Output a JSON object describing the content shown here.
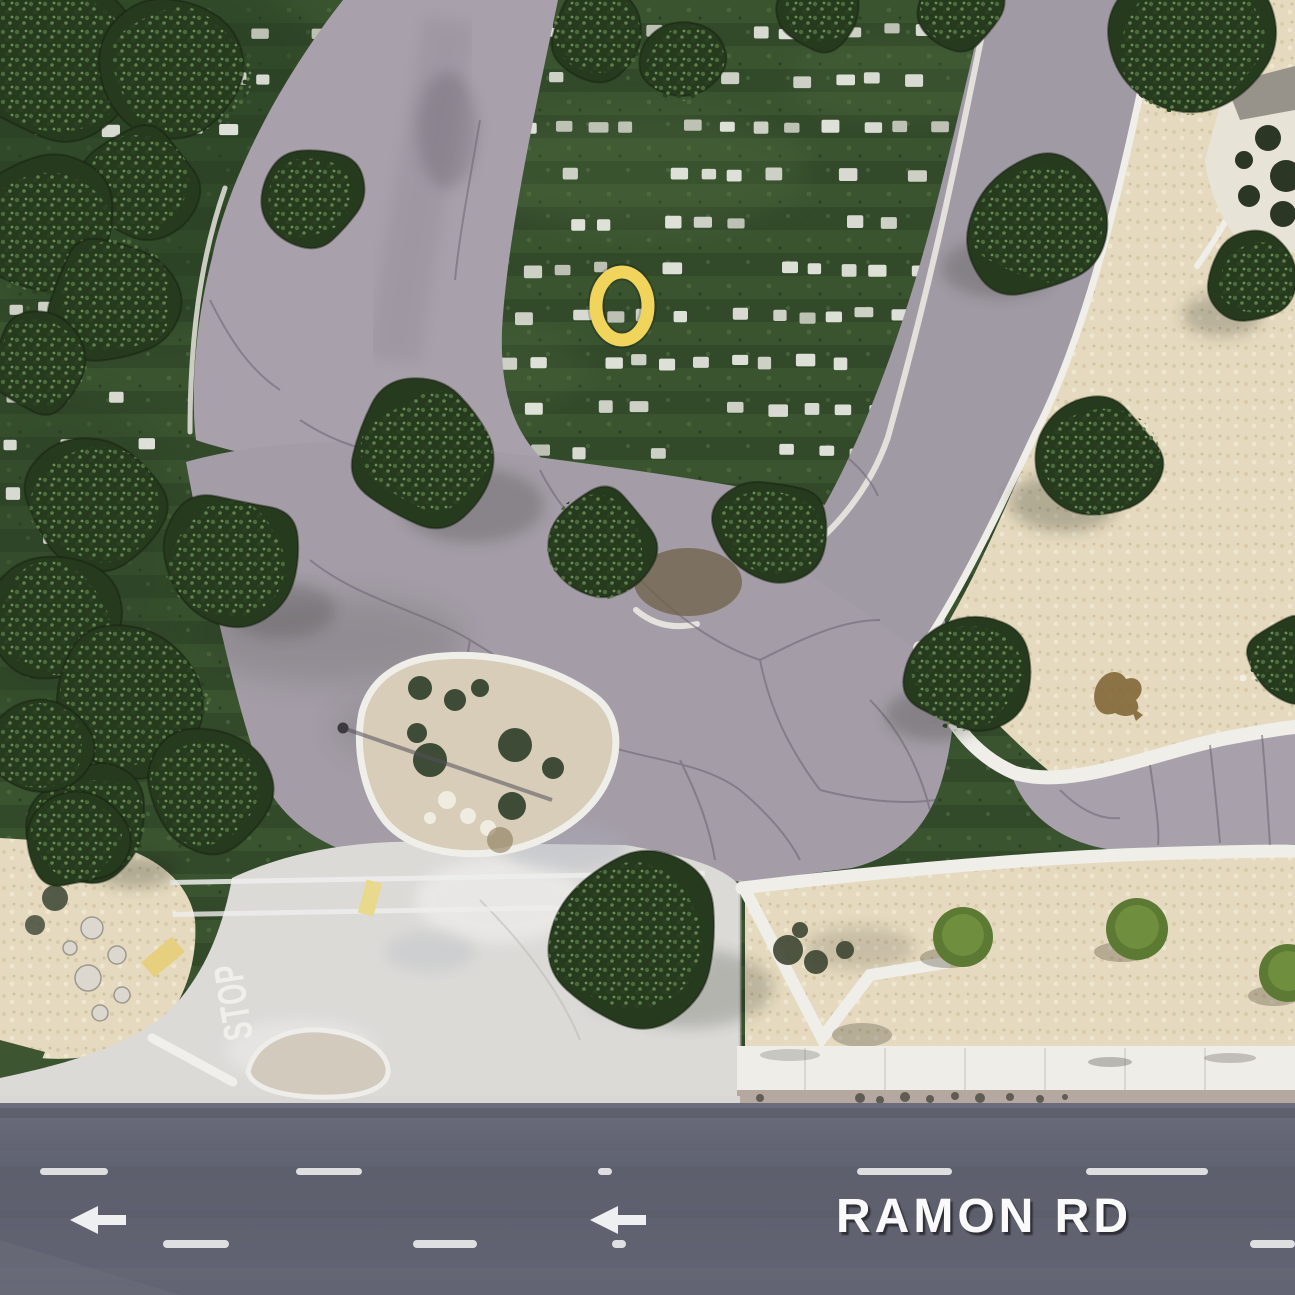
{
  "map": {
    "kind": "aerial-satellite-view",
    "location_hint": "Cemetery grounds and entrance driveway at Ramon Rd"
  },
  "road": {
    "label": "RAMON RD",
    "label_color": "#fafafa",
    "label_shadow": "#2b2b33",
    "surface_color": "#5e6070",
    "lane_arrow_direction": "left"
  },
  "entrance": {
    "stop_marking": "STOP",
    "marking_color": "#f2f1ec"
  },
  "marker": {
    "shape": "ellipse",
    "cx": 622,
    "cy": 306,
    "rx": 26,
    "ry": 34,
    "stroke_color": "#f1d45c",
    "stroke_width": 13
  },
  "palette": {
    "grass": "#3a5430",
    "grass_dark": "#32492a",
    "tree": "#263a1e",
    "pavement": "#a49da7",
    "concrete": "#dbdad7",
    "sand": "#e5dabf",
    "curb_white": "#efeee9",
    "road": "#5e6070",
    "sidewalk": "#efede8",
    "yellow_curb": "#e6cf7f"
  },
  "scene_data": {
    "headstone_rows": [
      {
        "y": 26,
        "x1": 348,
        "x2": 982,
        "seed": 11
      },
      {
        "y": 74,
        "x1": 348,
        "x2": 986,
        "seed": 23
      },
      {
        "y": 122,
        "x1": 344,
        "x2": 986,
        "seed": 37
      },
      {
        "y": 170,
        "x1": 338,
        "x2": 980,
        "seed": 41
      },
      {
        "y": 218,
        "x1": 334,
        "x2": 976,
        "seed": 53
      },
      {
        "y": 264,
        "x1": 334,
        "x2": 970,
        "seed": 67
      },
      {
        "y": 310,
        "x1": 330,
        "x2": 964,
        "seed": 71
      },
      {
        "y": 356,
        "x1": 330,
        "x2": 958,
        "seed": 83
      },
      {
        "y": 402,
        "x1": 330,
        "x2": 950,
        "seed": 97
      },
      {
        "y": 446,
        "x1": 334,
        "x2": 940,
        "seed": 101
      },
      {
        "y": 26,
        "x1": 0,
        "x2": 340,
        "seed": 7
      },
      {
        "y": 74,
        "x1": 0,
        "x2": 332,
        "seed": 13
      },
      {
        "y": 122,
        "x1": 0,
        "x2": 240,
        "seed": 17
      },
      {
        "y": 302,
        "x1": 0,
        "x2": 152,
        "seed": 19
      },
      {
        "y": 348,
        "x1": 0,
        "x2": 162,
        "seed": 29
      },
      {
        "y": 394,
        "x1": 0,
        "x2": 166,
        "seed": 31
      },
      {
        "y": 440,
        "x1": 0,
        "x2": 172,
        "seed": 43
      },
      {
        "y": 486,
        "x1": 0,
        "x2": 124,
        "seed": 47
      },
      {
        "y": 532,
        "x1": 0,
        "x2": 84,
        "seed": 59
      },
      {
        "y": 578,
        "x1": 0,
        "x2": 62,
        "seed": 61
      },
      {
        "y": 622,
        "x1": 0,
        "x2": 52,
        "seed": 73
      }
    ],
    "trees": [
      [
        55,
        60,
        92
      ],
      [
        180,
        68,
        80
      ],
      [
        140,
        186,
        64
      ],
      [
        45,
        230,
        80
      ],
      [
        115,
        298,
        70
      ],
      [
        40,
        362,
        56
      ],
      [
        310,
        198,
        56
      ],
      [
        598,
        36,
        52
      ],
      [
        682,
        62,
        46
      ],
      [
        820,
        12,
        46
      ],
      [
        958,
        6,
        48
      ],
      [
        1040,
        224,
        82
      ],
      [
        1190,
        42,
        88
      ],
      [
        1255,
        280,
        50
      ],
      [
        95,
        506,
        76
      ],
      [
        233,
        562,
        76
      ],
      [
        55,
        620,
        68
      ],
      [
        128,
        702,
        90
      ],
      [
        207,
        792,
        68
      ],
      [
        90,
        822,
        62
      ],
      [
        38,
        748,
        58
      ],
      [
        428,
        452,
        78
      ],
      [
        597,
        546,
        62
      ],
      [
        773,
        532,
        62
      ],
      [
        1099,
        461,
        66
      ],
      [
        970,
        673,
        70
      ],
      [
        1292,
        662,
        48
      ],
      [
        630,
        940,
        95
      ],
      [
        75,
        839,
        56
      ]
    ],
    "lane_dashes": [
      {
        "y": 1168,
        "h": 7,
        "segs": [
          [
            40,
            68
          ],
          [
            296,
            66
          ],
          [
            598,
            14
          ],
          [
            857,
            95
          ],
          [
            1086,
            122
          ]
        ]
      },
      {
        "y": 1240,
        "h": 8,
        "segs": [
          [
            163,
            66
          ],
          [
            413,
            64
          ],
          [
            612,
            14
          ],
          [
            1250,
            45
          ]
        ]
      }
    ],
    "arrows": [
      {
        "x": 70,
        "y": 1206
      },
      {
        "x": 590,
        "y": 1206
      }
    ]
  }
}
